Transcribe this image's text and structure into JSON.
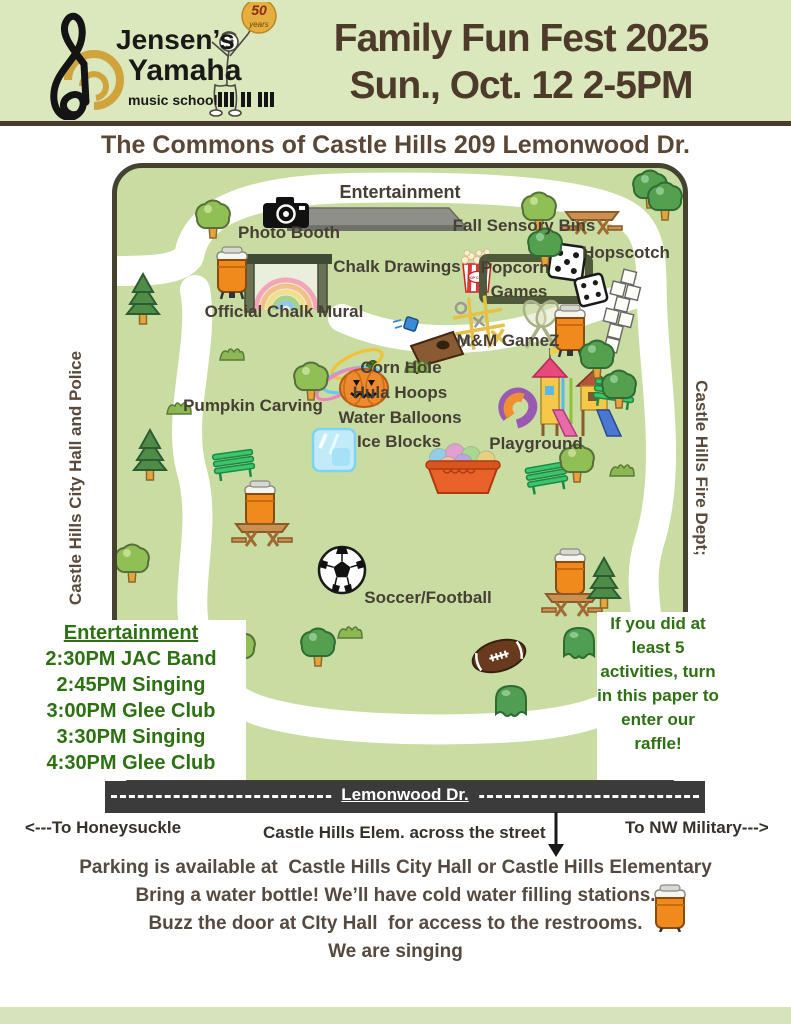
{
  "header": {
    "brand_line1": "Jensen’s",
    "brand_line2": "Yamaha",
    "brand_line3": "music school",
    "balloon_top": "50",
    "balloon_bottom": "years",
    "title_line1": "Family Fun Fest 2025",
    "title_line2": "Sun., Oct. 12 2-5PM"
  },
  "map": {
    "title": "The Commons of Castle Hills  209 Lemonwood Dr.",
    "left_side_label": "Castle Hills City Hall and Police",
    "right_side_label": "Castle Hills Fire Dept;",
    "popcorn_box_label": "POP CORN",
    "labels": [
      "Entertainment",
      "Photo Booth",
      "Fall Sensory Bins",
      "Chalk Drawings",
      "Popcorn",
      "Games",
      "Hopscotch",
      "Official Chalk Mural",
      "M&M GameZ",
      "Corn Hole",
      "Hula Hoops",
      "Water Balloons",
      "Ice Blocks",
      "Pumpkin Carving",
      "Playground",
      "Soccer/Football"
    ]
  },
  "entertainment_schedule": {
    "heading": "Entertainment",
    "items": [
      "2:30PM JAC Band",
      "2:45PM Singing",
      "3:00PM Glee Club",
      "3:30PM Singing",
      "4:30PM Glee Club"
    ]
  },
  "raffle_note": "If you did at least 5 activities, turn in this paper to enter our raffle!",
  "road": {
    "name": "Lemonwood Dr.",
    "left_direction": "<---To Honeysuckle",
    "center_note": "Castle Hills Elem. across the street",
    "right_direction": "To NW Military--->"
  },
  "footer": {
    "line1": "Parking is available at  Castle Hills City Hall or Castle Hills Elementary",
    "line2": "Bring a water bottle! We’ll have cold water filling stations.",
    "line3": "Buzz the door at CIty Hall  for access to the restrooms.",
    "line4": "We are singing"
  },
  "colors": {
    "header_bg": "#dbe7bd",
    "map_green": "#c9dca2",
    "path_white": "#ffffff",
    "road_gray": "#3b3b3b",
    "title_brown": "#4e3a2b",
    "schedule_green": "#2d7113",
    "cooler_orange": "#f08a1d"
  }
}
